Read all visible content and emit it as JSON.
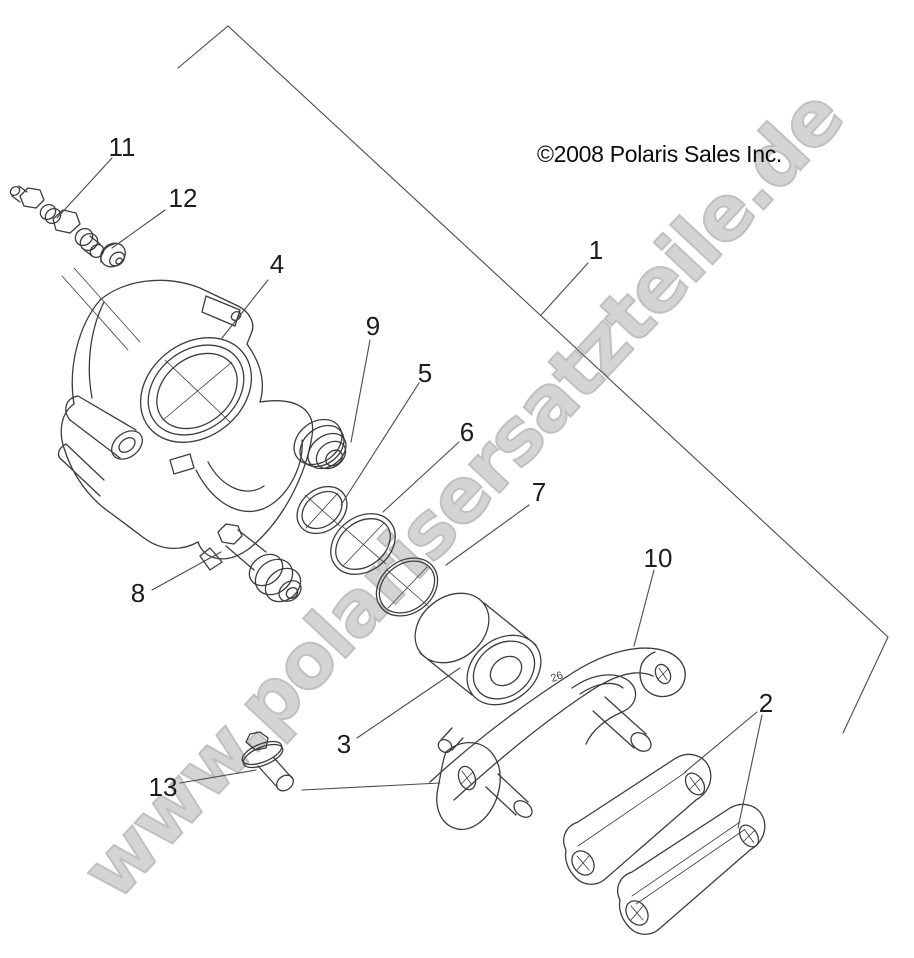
{
  "copyright": {
    "text": "©2008 Polaris Sales Inc."
  },
  "watermark": {
    "text": "www.polarisersatzteile.de"
  },
  "bracket_marking": {
    "text": "26"
  },
  "callouts": {
    "c1": {
      "label": "1"
    },
    "c2": {
      "label": "2"
    },
    "c3": {
      "label": "3"
    },
    "c4": {
      "label": "4"
    },
    "c5": {
      "label": "5"
    },
    "c6": {
      "label": "6"
    },
    "c7": {
      "label": "7"
    },
    "c8": {
      "label": "8"
    },
    "c9": {
      "label": "9"
    },
    "c10": {
      "label": "10"
    },
    "c11": {
      "label": "11"
    },
    "c12": {
      "label": "12"
    },
    "c13": {
      "label": "13"
    }
  },
  "colors": {
    "background": "#ffffff",
    "line_art": "#3c3c3c",
    "leader_line": "#4a4a4a",
    "callout_text": "#1c1c1c",
    "watermark_fill": "#d4d4d4",
    "watermark_outline": "#c0c0c0"
  }
}
